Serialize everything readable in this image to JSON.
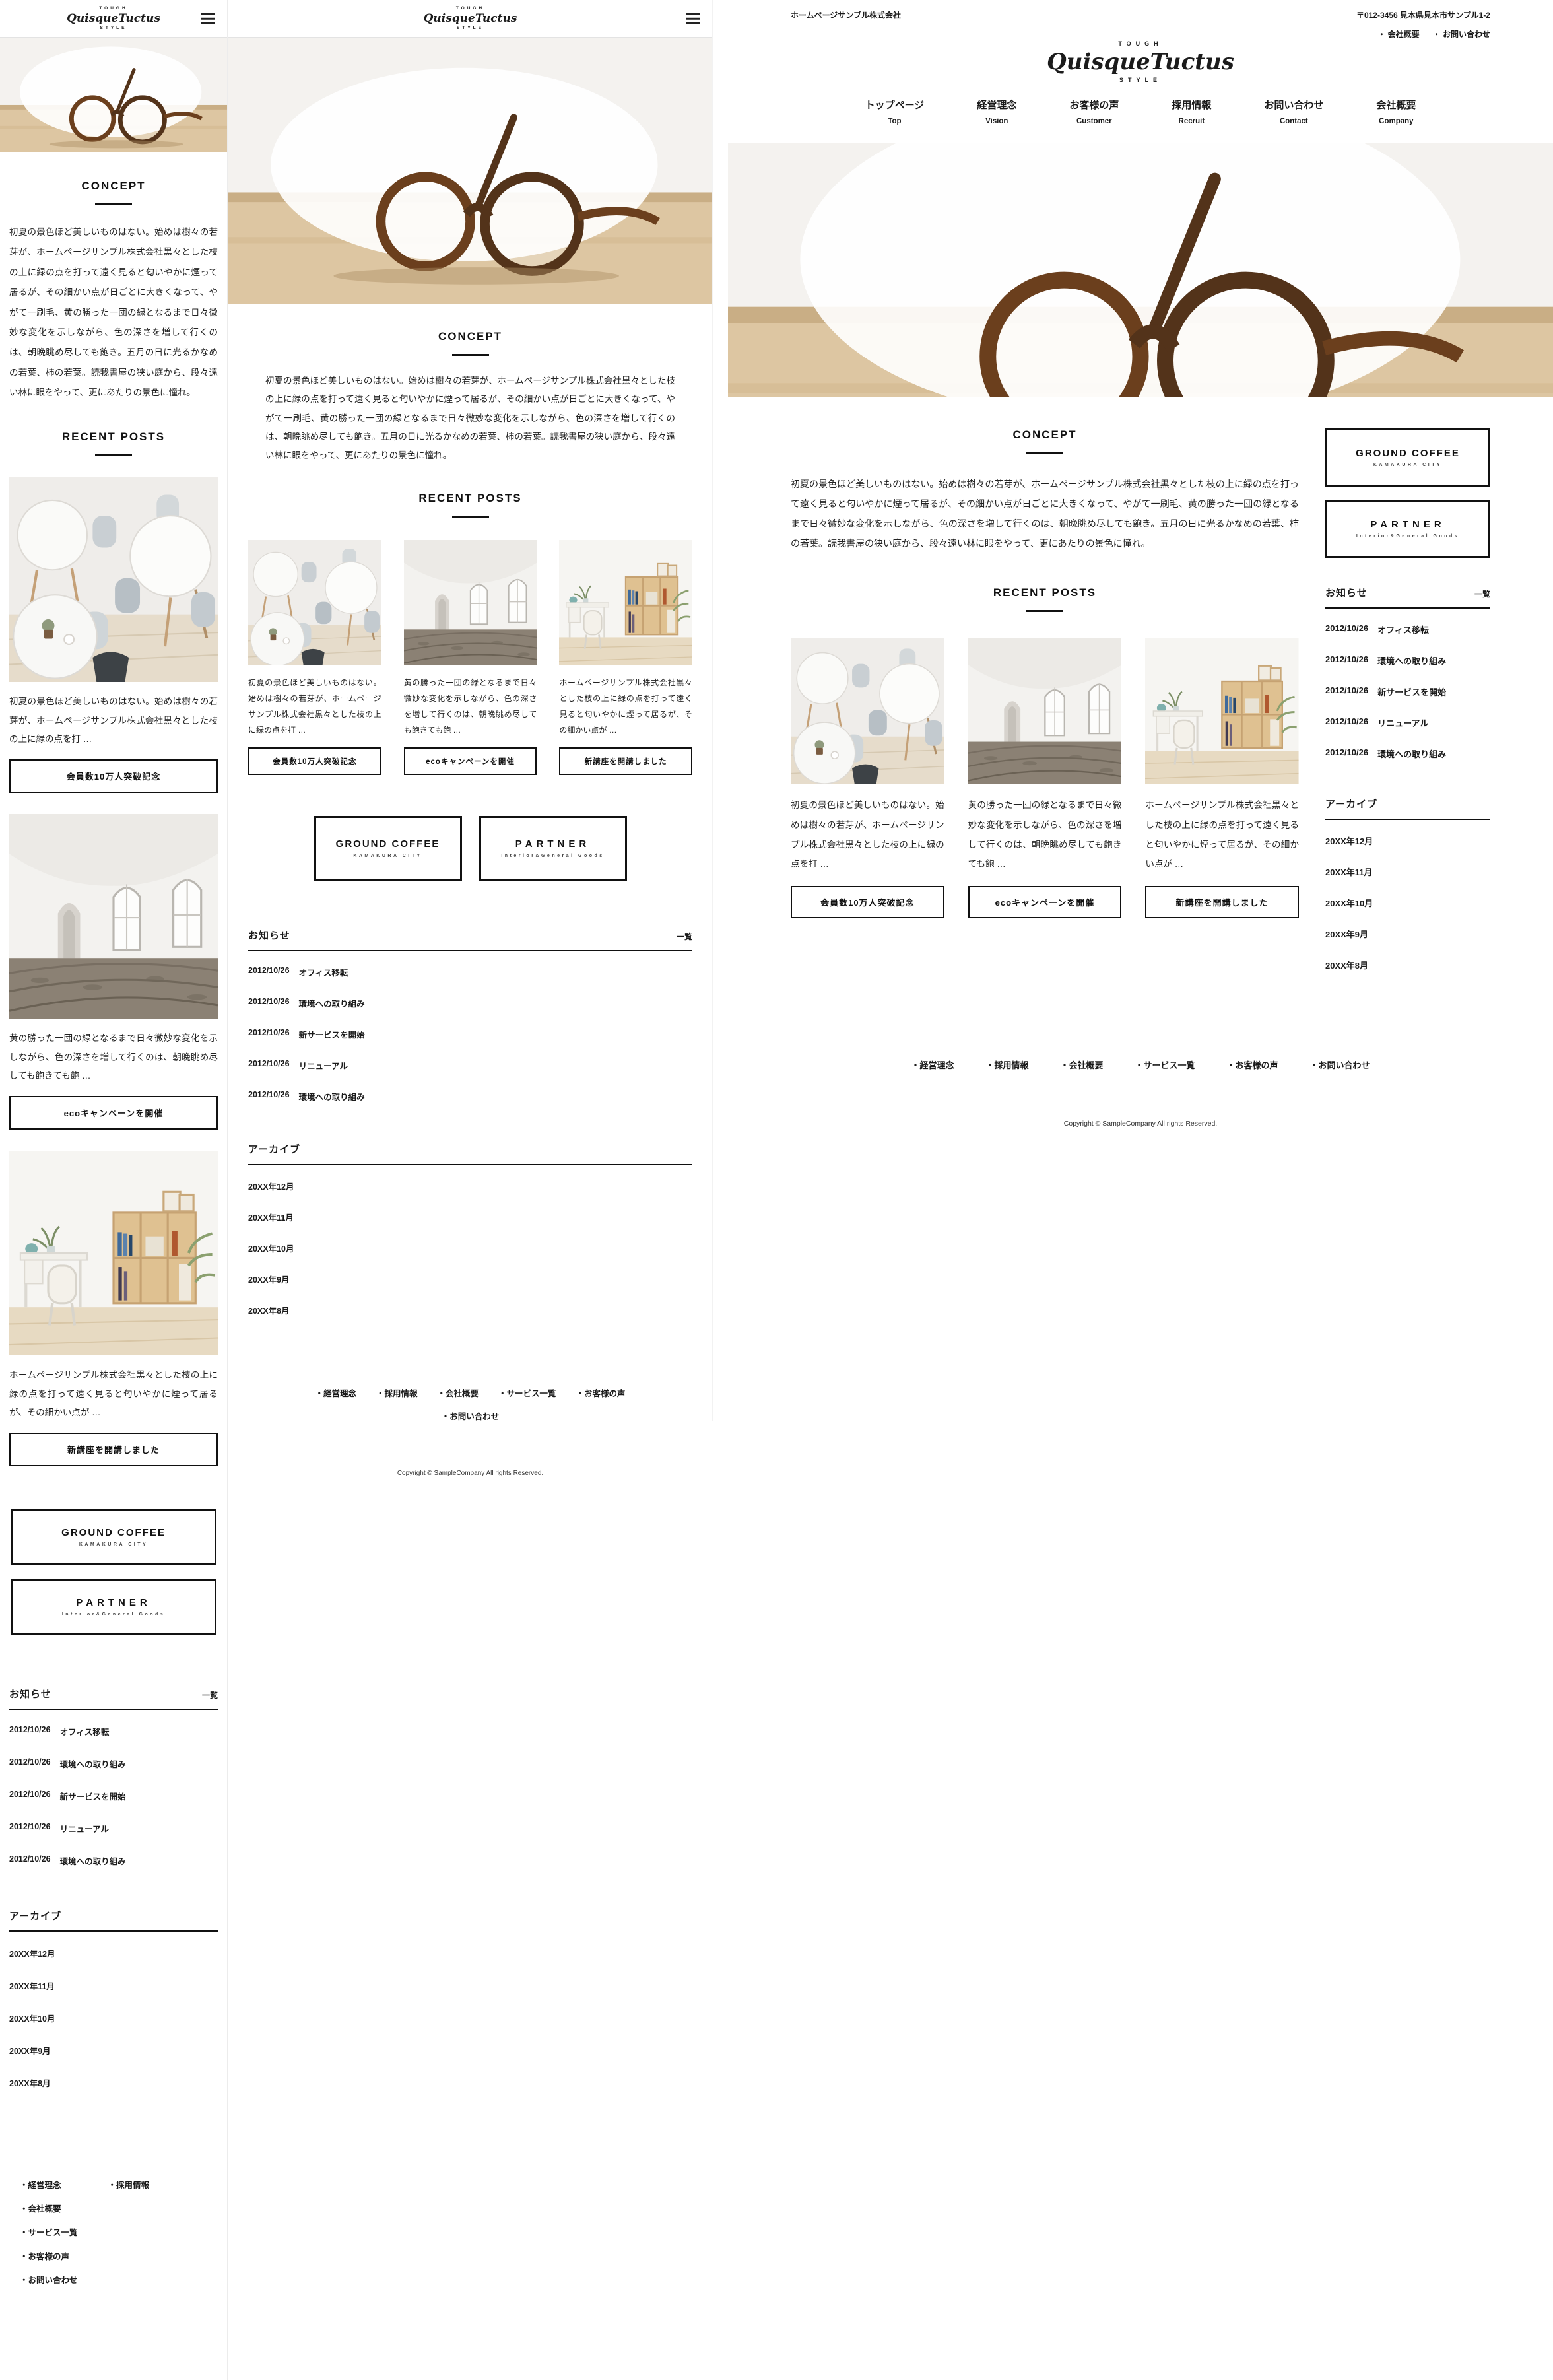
{
  "brand": {
    "tagline_top": "TOUGH",
    "name": "QuisqueTuctus",
    "tagline_bottom": "STYLE"
  },
  "topbar": {
    "company": "ホームページサンプル株式会社",
    "address": "〒012-3456 見本県見本市サンプル1-2",
    "links": [
      {
        "label": "・ 会社概要"
      },
      {
        "label": "・ お問い合わせ"
      }
    ]
  },
  "nav": {
    "items": [
      {
        "jp": "トップページ",
        "en": "Top"
      },
      {
        "jp": "経営理念",
        "en": "Vision"
      },
      {
        "jp": "お客様の声",
        "en": "Customer"
      },
      {
        "jp": "採用情報",
        "en": "Recruit"
      },
      {
        "jp": "お問い合わせ",
        "en": "Contact"
      },
      {
        "jp": "会社概要",
        "en": "Company"
      }
    ]
  },
  "concept": {
    "title": "CONCEPT",
    "body": "初夏の景色ほど美しいものはない。始めは樹々の若芽が、ホームページサンプル株式会社黒々とした枝の上に緑の点を打って遠く見ると匂いやかに煙って居るが、その細かい点が日ごとに大きくなって、やがて一刷毛、黄の勝った一団の緑となるまで日々微妙な変化を示しながら、色の深さを増して行くのは、朝晩眺め尽しても飽き。五月の日に光るかなめの若葉、柿の若葉。読我書屋の狭い庭から、段々遠い林に眼をやって、更にあたりの景色に憧れ。"
  },
  "posts": {
    "title": "RECENT POSTS",
    "items": [
      {
        "image": "cafe-interior-photo",
        "excerpt": "初夏の景色ほど美しいものはない。始めは樹々の若芽が、ホームページサンプル株式会社黒々とした枝の上に緑の点を打 …",
        "button": "会員数10万人突破記念"
      },
      {
        "image": "arched-room-photo",
        "excerpt": "黄の勝った一団の緑となるまで日々微妙な変化を示しながら、色の深さを増して行くのは、朝晩眺め尽しても飽きても飽 …",
        "button": "ecoキャンペーンを開催"
      },
      {
        "image": "desk-shelf-photo",
        "excerpt": "ホームページサンプル株式会社黒々とした枝の上に緑の点を打って遠く見ると匂いやかに煙って居るが、その細かい点が …",
        "button": "新講座を開講しました"
      }
    ]
  },
  "banners": [
    {
      "title": "GROUND COFFEE",
      "subtitle": "KAMAKURA CITY"
    },
    {
      "title": "PARTNER",
      "subtitle": "Interior&General Goods"
    }
  ],
  "news": {
    "title": "お知らせ",
    "more": "一覧",
    "items": [
      {
        "date": "2012/10/26",
        "label": "オフィス移転"
      },
      {
        "date": "2012/10/26",
        "label": "環境への取り組み"
      },
      {
        "date": "2012/10/26",
        "label": "新サービスを開始"
      },
      {
        "date": "2012/10/26",
        "label": "リニューアル"
      },
      {
        "date": "2012/10/26",
        "label": "環境への取り組み"
      }
    ]
  },
  "archive": {
    "title": "アーカイブ",
    "items": [
      {
        "label": "20XX年12月"
      },
      {
        "label": "20XX年11月"
      },
      {
        "label": "20XX年10月"
      },
      {
        "label": "20XX年9月"
      },
      {
        "label": "20XX年8月"
      }
    ]
  },
  "footer": {
    "links": [
      {
        "label": "・経営理念"
      },
      {
        "label": "・採用情報"
      },
      {
        "label": "・会社概要"
      },
      {
        "label": "・サービス一覧"
      },
      {
        "label": "・お客様の声"
      },
      {
        "label": "・お問い合わせ"
      }
    ],
    "copyright": "Copyright © SampleCompany All rights Reserved."
  },
  "colors": {
    "text": "#1a1a1a",
    "border_black": "#111111",
    "header_border": "#e3e3e3",
    "desk_wood": "#ddc6a2",
    "glasses_frame": "#6b3f1d"
  }
}
